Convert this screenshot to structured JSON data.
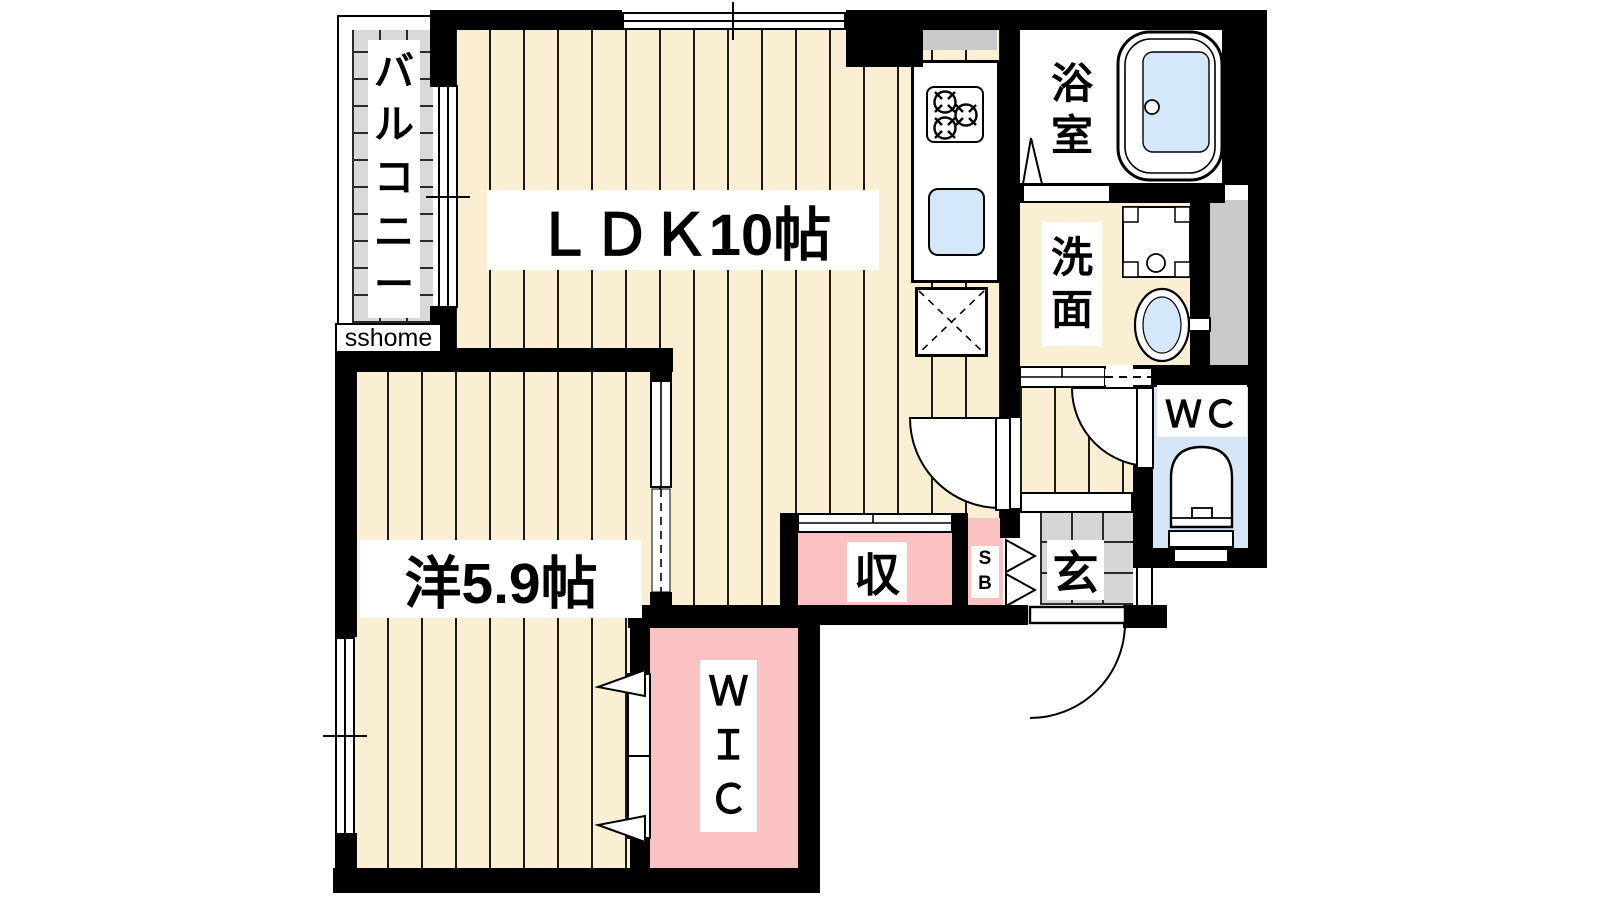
{
  "plan": {
    "brand": "sshome",
    "rooms": {
      "balcony": {
        "label": "バ\nル\nコ\nニ\nー"
      },
      "ldk": {
        "label": "ＬＤＫ10帖"
      },
      "bathroom": {
        "label": "浴\n室"
      },
      "washroom": {
        "label": "洗\n面"
      },
      "wc": {
        "label": "ＷＣ"
      },
      "western": {
        "label": "洋5.9帖"
      },
      "storage": {
        "label": "収"
      },
      "shoebox": {
        "label": "S\nB"
      },
      "entrance": {
        "label": "玄"
      },
      "wic": {
        "label": "Ｗ\nＩ\nＣ"
      }
    },
    "colors": {
      "floor_cream": "#faefd2",
      "closet_pink": "#fbc2c4",
      "wc_floor_blue": "#d7e6f7",
      "fixture_blue": "#d4e8fa",
      "tile_gray": "#d6d6d6",
      "wall_black": "#000000"
    }
  }
}
